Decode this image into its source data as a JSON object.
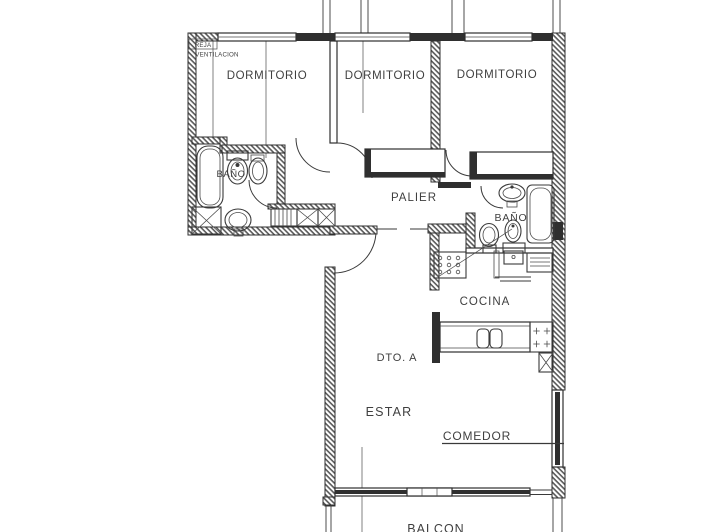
{
  "plan": {
    "type": "floor-plan",
    "unit": "DTO. A",
    "labels": {
      "reja_line1": "REJA",
      "reja_line2": "VENTILACION",
      "dormitorio1": "DORMITORIO",
      "dormitorio2": "DORMITORIO",
      "dormitorio3": "DORMITORIO",
      "palier": "PALIER",
      "bano1": "BAÑO",
      "bano2": "BAÑO",
      "cocina": "COCINA",
      "dto_a": "DTO. A",
      "estar": "ESTAR",
      "comedor": "COMEDOR",
      "balcon": "BALCON"
    },
    "colors": {
      "line": "#2f2f2f",
      "text": "#3f3f3f",
      "background": "#ffffff"
    }
  }
}
